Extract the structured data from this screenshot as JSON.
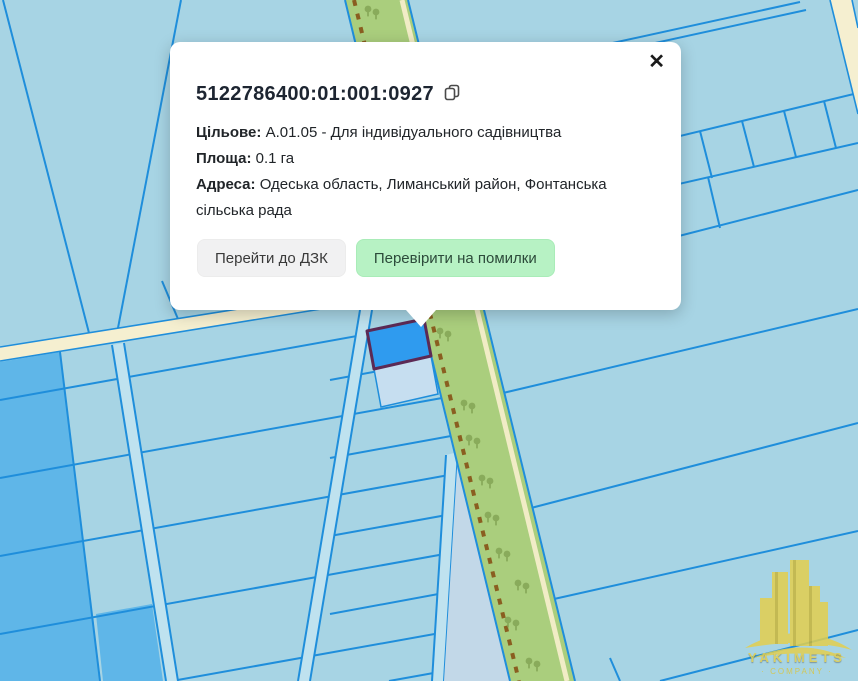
{
  "popup": {
    "cadastral_number": "5122786400:01:001:0927",
    "fields": [
      {
        "label": "Цільове:",
        "value": "А.01.05 - Для індивідуального садівництва"
      },
      {
        "label": "Площа:",
        "value": "0.1 га"
      },
      {
        "label": "Адреса:",
        "value": "Одеська область, Лиманський район, Фонтанська сільська рада"
      }
    ],
    "buttons": {
      "goto_dzk": "Перейти до ДЗК",
      "check_errors": "Перевірити на помилки"
    },
    "close_glyph": "✕"
  },
  "map": {
    "background_color": "#a7d4e4",
    "parcel_line_color": "#1f8edb",
    "dark_parcel_color": "#5fb6e8",
    "road_fill_color": "#bfe2ef",
    "cream_road_color": "#f5efd0",
    "greenbelt_color": "#aace7d",
    "greenbelt_dash_color": "#8a5e20",
    "selected_parcel_color": "#2f9bef",
    "selected_parcel_border": "#5c2a55"
  },
  "watermark": {
    "line1": "YAKIMETS",
    "line2": "· COMPANY ·"
  }
}
